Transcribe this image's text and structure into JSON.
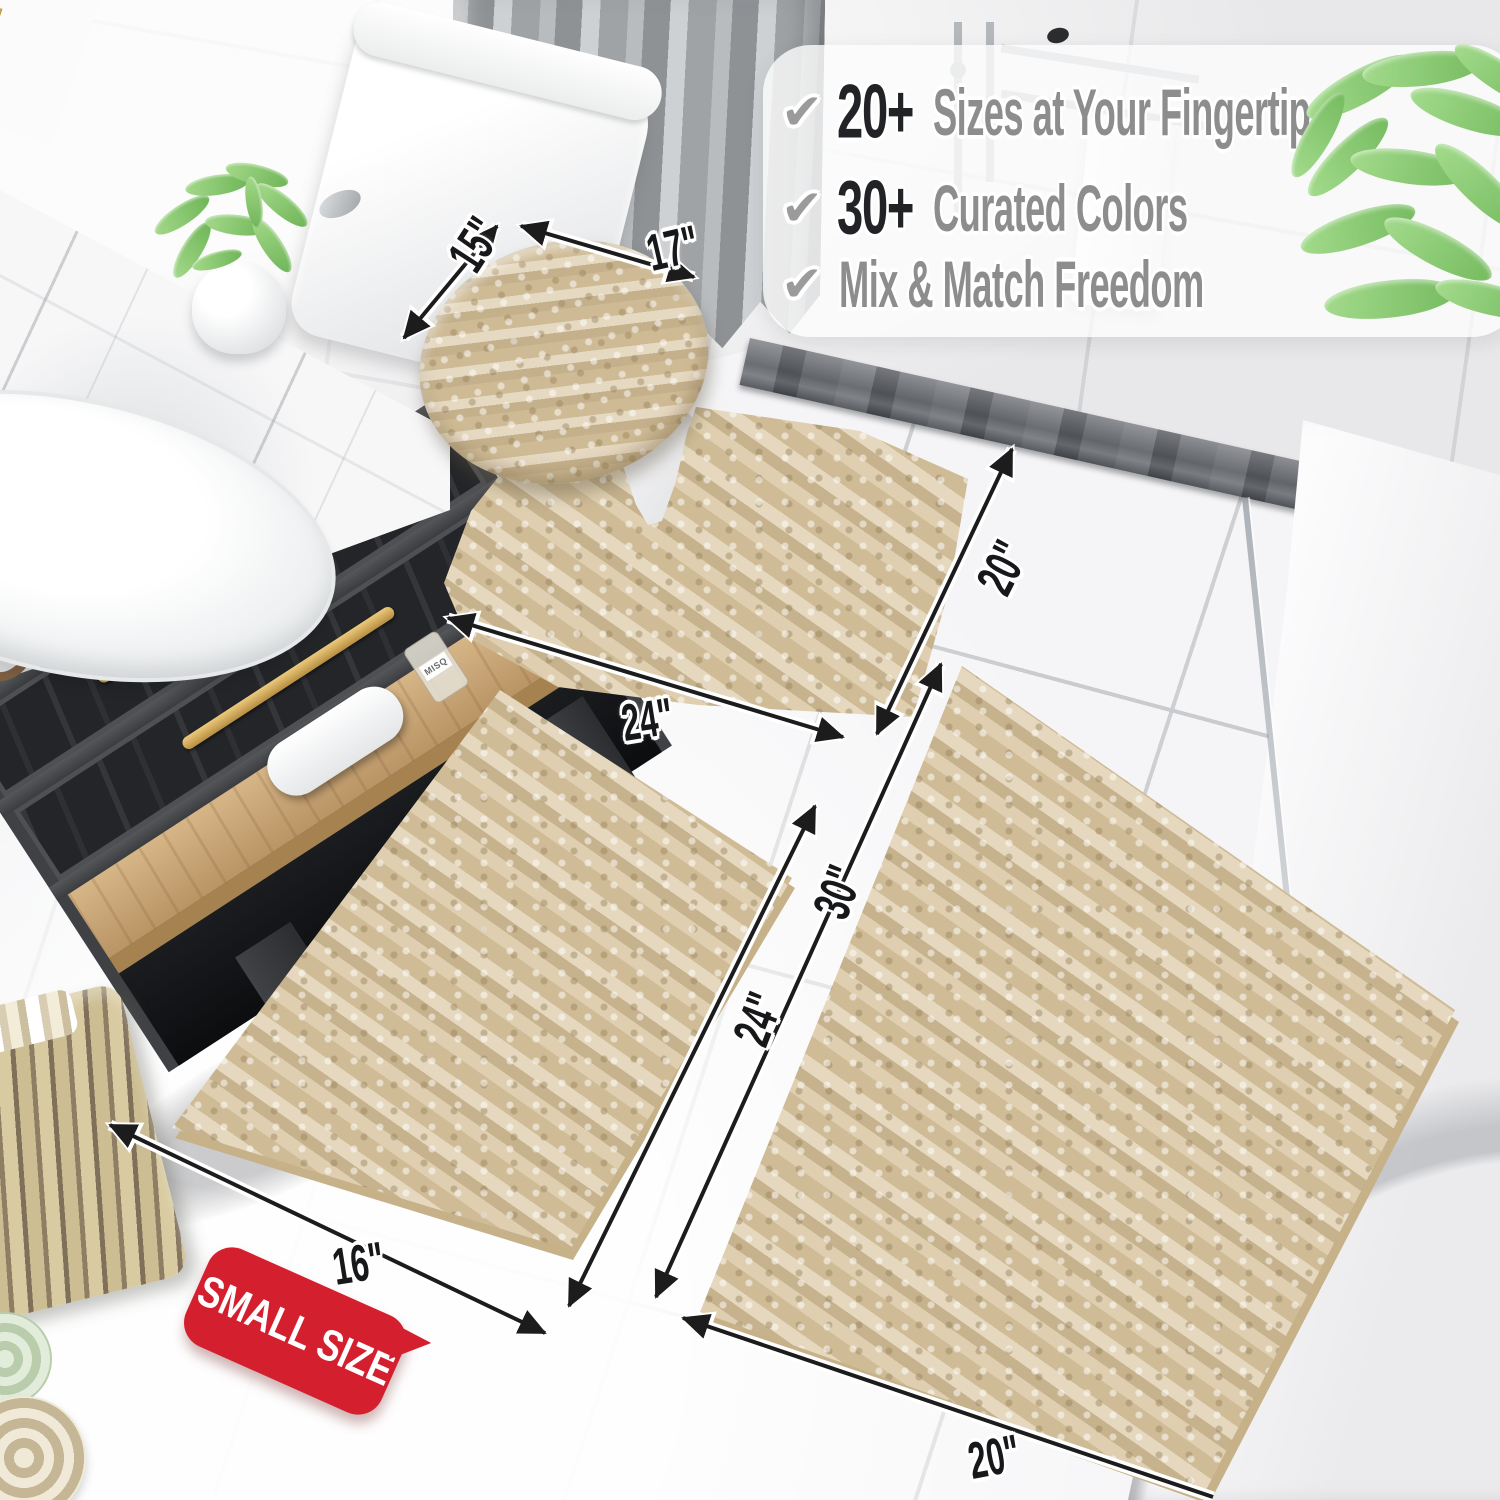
{
  "page": {
    "type": "product-photo",
    "subject": "beige chenille bathroom rug set shown in a bathroom"
  },
  "banner": {
    "background": "rgba(252,252,252,0.8)",
    "items": [
      {
        "icon": "check-icon",
        "stat": "20+",
        "label": "Sizes at Your Fingertips"
      },
      {
        "icon": "check-icon",
        "stat": "30+",
        "label": "Curated Colors"
      },
      {
        "icon": "check-icon",
        "stat": "",
        "label": "Mix & Match Freedom"
      }
    ]
  },
  "dims": {
    "lid_width": "15\"",
    "lid_length": "17\"",
    "contour_length": "24\"",
    "contour_width": "20\"",
    "small_rug_length": "24\"",
    "large_rug_length": "30\"",
    "small_rug_width": "16\"",
    "large_rug_width": "20\""
  },
  "badge": {
    "label": "SMALL SIZE",
    "color": "#d41f2f"
  },
  "decor": {
    "bottle_label": "MISQ"
  },
  "colors": {
    "rug_beige": "#d9c6a1",
    "badge_red": "#d41f2f",
    "stat_black": "#222326",
    "label_gray": "#8d8d8d",
    "check_gray": "#9b9b9b",
    "gold_handle": "#c9a24b",
    "curb_gray": "#5a5d62"
  }
}
